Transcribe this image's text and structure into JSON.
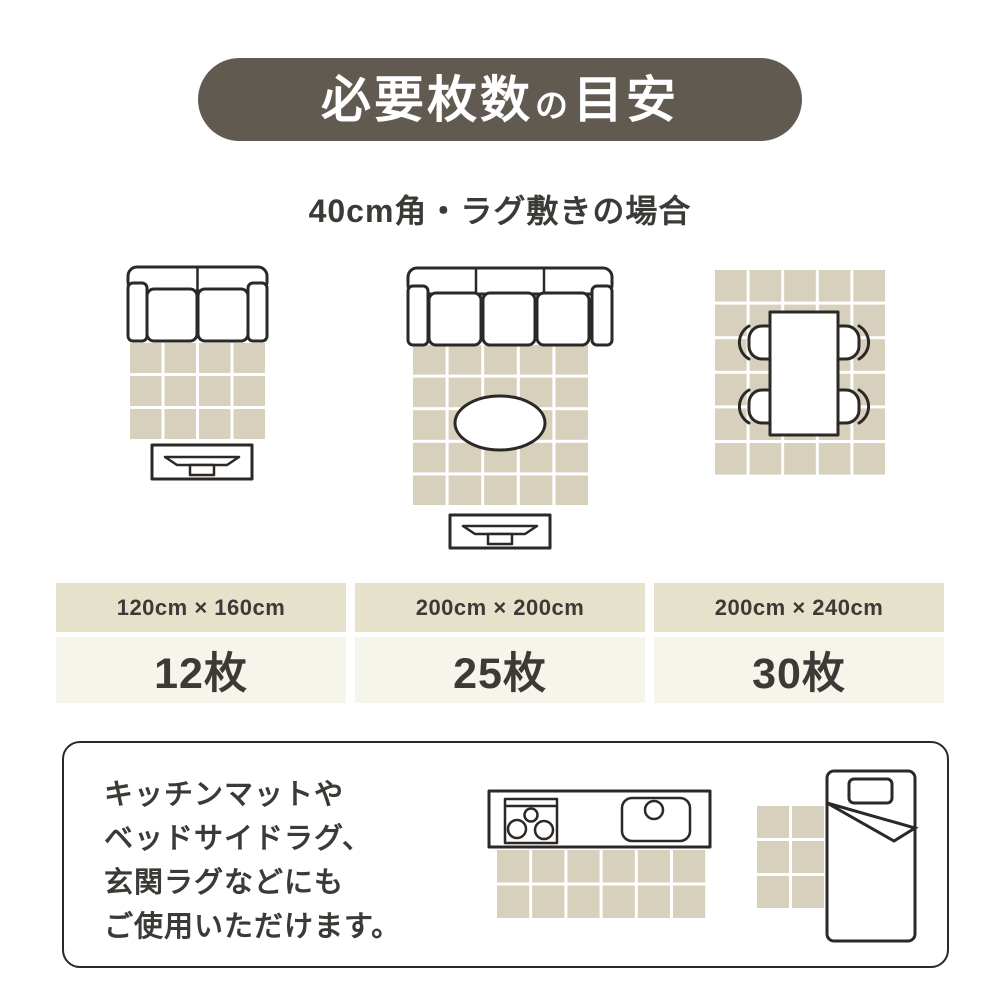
{
  "colors": {
    "pill_bg": "#615a50",
    "pill_text": "#ffffff",
    "tile": "#d6d0bd",
    "table_header_bg": "#e5e1cb",
    "table_cell_bg": "#f6f5ec",
    "outline": "#2b2826",
    "text": "#3c3a37"
  },
  "header": {
    "title": {
      "part1": "必要枚数",
      "particle": "の",
      "part2": "目安"
    },
    "subtitle": "40cm角・ラグ敷きの場合"
  },
  "diagrams": [
    {
      "name": "two-seat-sofa-with-rug-and-tv-board",
      "grid": {
        "cols": 4,
        "rows": 3
      }
    },
    {
      "name": "three-seat-sofa-with-rug-oval-table-and-tv-board",
      "grid": {
        "cols": 5,
        "rows": 5
      }
    },
    {
      "name": "dining-table-with-four-chairs-on-rug",
      "grid": {
        "cols": 5,
        "rows": 6
      }
    }
  ],
  "table": {
    "columns": [
      {
        "size": "120cm × 160cm",
        "count": "12枚"
      },
      {
        "size": "200cm × 200cm",
        "count": "25枚"
      },
      {
        "size": "200cm × 240cm",
        "count": "30枚"
      }
    ]
  },
  "note": {
    "lines": [
      "キッチンマットや",
      "ベッドサイドラグ、",
      "玄関ラグなどにも",
      "ご使用いただけます。"
    ],
    "illustrations": [
      {
        "name": "kitchen-counter-with-mat",
        "grid": {
          "cols": 6,
          "rows": 2
        }
      },
      {
        "name": "bed-with-bedside-rug",
        "grid": {
          "cols": 2,
          "rows": 3
        }
      }
    ]
  }
}
